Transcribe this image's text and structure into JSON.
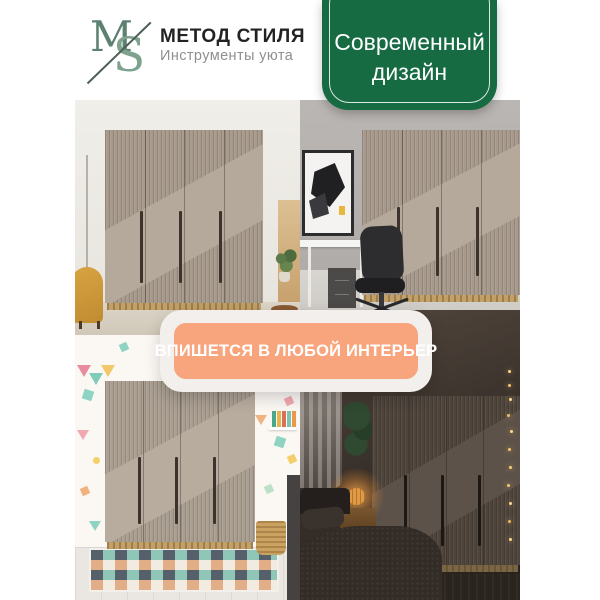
{
  "header": {
    "logo": {
      "letter_m": "M",
      "letter_s": "S"
    },
    "brand_name": "МЕТОД СТИЛЯ",
    "tagline": "Инструменты уюта"
  },
  "badge": {
    "line1": "Современный",
    "line2": "дизайн"
  },
  "banner": {
    "text": "ВПИШЕТСЯ В ЛЮБОЙ ИНТЕРЬЕР"
  },
  "colors": {
    "badge_green": "#176b43",
    "logo_green": "#7da28d",
    "banner_orange": "#f8a47c",
    "banner_container": "#f2efec",
    "brand_text": "#232323",
    "tagline_gray": "#8f8f8f"
  }
}
